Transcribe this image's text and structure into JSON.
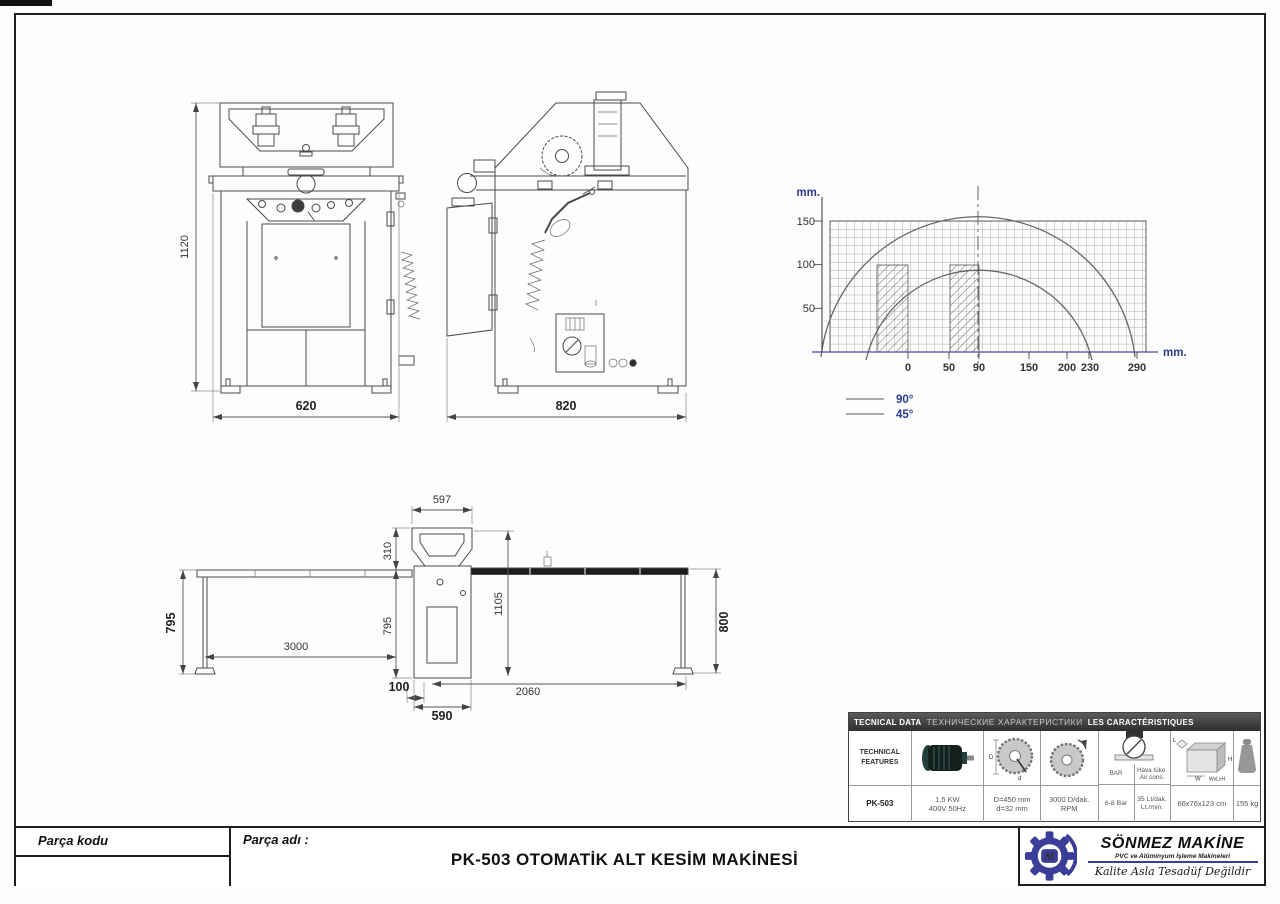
{
  "front_view": {
    "height": "1120",
    "width": "620"
  },
  "side_view": {
    "depth": "820"
  },
  "plan_view": {
    "hood_width": "597",
    "hood_depth": "310",
    "body_depth": "795",
    "left_table_depth": "795",
    "left_table_length": "3000",
    "offset": "100",
    "body_width": "590",
    "right_table_length": "2060",
    "right_table_depth": "800",
    "total_depth": "1105"
  },
  "chart": {
    "y_unit": "mm.",
    "x_unit": "mm.",
    "y_ticks": [
      "150",
      "100",
      "50"
    ],
    "x_ticks": [
      "0",
      "50",
      "90",
      "150",
      "200",
      "230",
      "290"
    ],
    "legend_90": "90°",
    "legend_45": "45°"
  },
  "chart_data": {
    "type": "line",
    "title": "Cutting capacity diagram",
    "xlabel": "mm.",
    "ylabel": "mm.",
    "x_ticks": [
      0,
      50,
      90,
      150,
      200,
      230,
      290
    ],
    "y_ticks": [
      50,
      100,
      150
    ],
    "xlim": [
      -100,
      300
    ],
    "ylim": [
      0,
      160
    ],
    "grid": true,
    "legend_position": "bottom-left",
    "centerline_x": 90,
    "series": [
      {
        "name": "90°",
        "points": [
          [
            -95,
            20
          ],
          [
            -50,
            85
          ],
          [
            0,
            120
          ],
          [
            50,
            142
          ],
          [
            90,
            148
          ],
          [
            150,
            138
          ],
          [
            200,
            112
          ],
          [
            250,
            62
          ],
          [
            290,
            0
          ]
        ]
      },
      {
        "name": "45°",
        "points": [
          [
            -48,
            0
          ],
          [
            0,
            93
          ],
          [
            50,
            135
          ],
          [
            90,
            148
          ],
          [
            130,
            135
          ],
          [
            180,
            95
          ],
          [
            230,
            0
          ]
        ]
      }
    ],
    "hatched_profiles": [
      {
        "x": [
          -40,
          0
        ],
        "y": [
          0,
          100
        ]
      },
      {
        "x": [
          50,
          90
        ],
        "y": [
          0,
          100
        ]
      }
    ]
  },
  "tech_table": {
    "header_en": "TECNICAL DATA",
    "header_ru": "ТЕХНИЧЕСКИЕ ХАРАКТЕРИСТИКИ",
    "header_fr": "LES CARACTÉRISTIQUES",
    "features_line1": "TECHNICAL",
    "features_line2": "FEATURES",
    "model": "PK-503",
    "motor_power": "1,5 KW",
    "motor_voltage": "400V 50Hz",
    "blade_diameter": "D=450 mm",
    "blade_bore": "d=32 mm",
    "speed": "3000 D/dak.",
    "speed_unit": "RPM",
    "pressure_header": "BAR",
    "pressure_value": "6-8 Bar",
    "air_header1": "Hava tüke.",
    "air_header2": "Air cons.",
    "air_value1": "35 Lt/dak.",
    "air_value2": "Lt./min.",
    "dims_value": "66x76x123 cm",
    "weight_value": "155 kg",
    "icon_labels": {
      "D": "D",
      "d": "d",
      "W": "W",
      "H": "H",
      "L": "L",
      "formula": "WxLxH"
    }
  },
  "title_block": {
    "part_code_label": "Parça kodu",
    "part_name_label": "Parça adı :",
    "title": "PK-503 OTOMATİK ALT KESİM MAKİNESİ"
  },
  "logo": {
    "company": "SÖNMEZ MAKİNE",
    "subtitle": "PVC ve Alüminyum İşleme Makineleri",
    "slogan": "Kalite Asla Tesadüf Değildir",
    "monogram": "M"
  },
  "colors": {
    "accent_blue": "#2b3b8f",
    "logo_blue": "#3b3e99",
    "axis_blue": "#4a4fa0"
  }
}
